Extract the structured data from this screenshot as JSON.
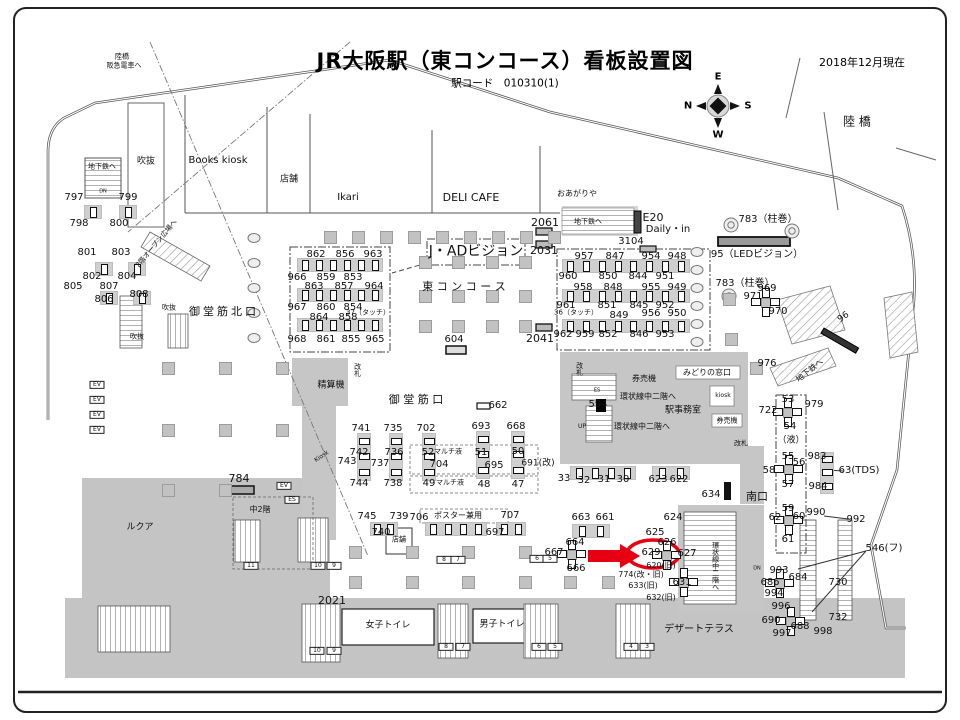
{
  "header": {
    "title": "JR大阪駅（東コンコース）看板設置図",
    "station_code": "駅コード　010310(1)",
    "date": "2018年12月現在"
  },
  "compass": {
    "top": "E",
    "left": "N",
    "right": "S",
    "bottom": "W"
  },
  "highlight": {
    "target_sign": "629",
    "marker": "red-arrow-and-red-circle",
    "color": "#e60012"
  },
  "map_labels": [
    {
      "t": "陸橋",
      "x": 122,
      "y": 57,
      "s": 7
    },
    {
      "t": "阪急電車へ",
      "x": 124,
      "y": 66,
      "s": 7
    },
    {
      "t": "地下鉄へ",
      "x": 102,
      "y": 167,
      "s": 7
    },
    {
      "t": "DN",
      "x": 103,
      "y": 192,
      "s": 5
    },
    {
      "t": "吹抜",
      "x": 146,
      "y": 162,
      "s": 9
    },
    {
      "t": "Books kiosk",
      "x": 218,
      "y": 161,
      "s": 10
    },
    {
      "t": "店舗",
      "x": 289,
      "y": 180,
      "s": 9
    },
    {
      "t": "Ikari",
      "x": 348,
      "y": 198,
      "s": 10
    },
    {
      "t": "DELI CAFE",
      "x": 471,
      "y": 198,
      "s": 11
    },
    {
      "t": "おあがりや",
      "x": 577,
      "y": 194,
      "s": 8
    },
    {
      "t": "地下鉄へ",
      "x": 588,
      "y": 222,
      "s": 7
    },
    {
      "t": "E20",
      "x": 653,
      "y": 218,
      "s": 11
    },
    {
      "t": "Daily・in",
      "x": 668,
      "y": 230,
      "s": 10
    },
    {
      "t": "陸 橋",
      "x": 857,
      "y": 122,
      "s": 12
    },
    {
      "t": "2階オープン広場へ",
      "x": 157,
      "y": 244,
      "s": 7,
      "r": -50
    },
    {
      "t": "御堂筋北口",
      "x": 224,
      "y": 312,
      "s": 11,
      "sp": 3
    },
    {
      "t": "J・ADビジョン",
      "x": 476,
      "y": 252,
      "s": 14
    },
    {
      "t": "東 コ ン コ ー ス",
      "x": 464,
      "y": 287,
      "s": 11
    },
    {
      "t": "吹抜",
      "x": 169,
      "y": 308,
      "s": 7
    },
    {
      "t": "吹抜",
      "x": 137,
      "y": 337,
      "s": 7
    },
    {
      "t": "783（柱巻）",
      "x": 768,
      "y": 220,
      "s": 10
    },
    {
      "t": "95（LEDビジョン）",
      "x": 757,
      "y": 255,
      "s": 10
    },
    {
      "t": "783（柱巻）",
      "x": 745,
      "y": 284,
      "s": 10
    },
    {
      "t": "96",
      "x": 844,
      "y": 318,
      "s": 9,
      "r": -35
    },
    {
      "t": "地下鉄へ",
      "x": 810,
      "y": 371,
      "s": 8,
      "r": -38
    },
    {
      "t": "精算機",
      "x": 331,
      "y": 386,
      "s": 9
    },
    {
      "t": "改札",
      "x": 357,
      "y": 370,
      "s": 7,
      "v": 1
    },
    {
      "t": "改札",
      "x": 579,
      "y": 369,
      "s": 7,
      "v": 1
    },
    {
      "t": "御 堂 筋 口",
      "x": 416,
      "y": 400,
      "s": 11
    },
    {
      "t": "マルチ液",
      "x": 448,
      "y": 452,
      "s": 7
    },
    {
      "t": "マルチ液",
      "x": 450,
      "y": 483,
      "s": 7
    },
    {
      "t": "券売機",
      "x": 644,
      "y": 379,
      "s": 8
    },
    {
      "t": "みどりの窓口",
      "x": 707,
      "y": 373,
      "s": 8
    },
    {
      "t": "環状線中二階へ",
      "x": 648,
      "y": 397,
      "s": 8
    },
    {
      "t": "駅事務室",
      "x": 683,
      "y": 411,
      "s": 9
    },
    {
      "t": "環状線中二階へ",
      "x": 642,
      "y": 427,
      "s": 8
    },
    {
      "t": "UP",
      "x": 582,
      "y": 427,
      "s": 6
    },
    {
      "t": "ES",
      "x": 597,
      "y": 391,
      "s": 5
    },
    {
      "t": "kiosk",
      "x": 723,
      "y": 396,
      "s": 6
    },
    {
      "t": "券売機",
      "x": 727,
      "y": 421,
      "s": 7
    },
    {
      "t": "改札",
      "x": 741,
      "y": 444,
      "s": 7
    },
    {
      "t": "南口",
      "x": 757,
      "y": 497,
      "s": 11
    },
    {
      "t": "（液）",
      "x": 791,
      "y": 441,
      "s": 9
    },
    {
      "t": "63(TDS)",
      "x": 859,
      "y": 471,
      "s": 10
    },
    {
      "t": "546(フ)",
      "x": 884,
      "y": 549,
      "s": 10
    },
    {
      "t": "ルクア",
      "x": 140,
      "y": 528,
      "s": 9
    },
    {
      "t": "中2階",
      "x": 260,
      "y": 510,
      "s": 8
    },
    {
      "t": "Kiosk",
      "x": 322,
      "y": 457,
      "s": 6,
      "r": -35
    },
    {
      "t": "店舗",
      "x": 399,
      "y": 540,
      "s": 7
    },
    {
      "t": "ポスター兼用",
      "x": 458,
      "y": 516,
      "s": 8
    },
    {
      "t": "女子トイレ",
      "x": 388,
      "y": 626,
      "s": 9
    },
    {
      "t": "男子トイレ",
      "x": 502,
      "y": 625,
      "s": 9
    },
    {
      "t": "デザートテラス",
      "x": 699,
      "y": 630,
      "s": 10
    },
    {
      "t": "環状線中二階へ",
      "x": 715,
      "y": 566,
      "s": 7,
      "v": 1
    },
    {
      "t": "DN",
      "x": 757,
      "y": 569,
      "s": 5
    },
    {
      "t": "797",
      "x": 74,
      "y": 198,
      "s": 10
    },
    {
      "t": "799",
      "x": 128,
      "y": 198,
      "s": 10
    },
    {
      "t": "798",
      "x": 79,
      "y": 224,
      "s": 10
    },
    {
      "t": "800",
      "x": 119,
      "y": 224,
      "s": 10
    },
    {
      "t": "801",
      "x": 87,
      "y": 253,
      "s": 10
    },
    {
      "t": "803",
      "x": 121,
      "y": 253,
      "s": 10
    },
    {
      "t": "802",
      "x": 92,
      "y": 277,
      "s": 10
    },
    {
      "t": "804",
      "x": 127,
      "y": 277,
      "s": 10
    },
    {
      "t": "805",
      "x": 73,
      "y": 287,
      "s": 10
    },
    {
      "t": "807",
      "x": 109,
      "y": 287,
      "s": 10
    },
    {
      "t": "806",
      "x": 104,
      "y": 300,
      "s": 10
    },
    {
      "t": "808",
      "x": 139,
      "y": 295,
      "s": 10
    },
    {
      "t": "862",
      "x": 316,
      "y": 255,
      "s": 10
    },
    {
      "t": "856",
      "x": 345,
      "y": 255,
      "s": 10
    },
    {
      "t": "963",
      "x": 373,
      "y": 255,
      "s": 10
    },
    {
      "t": "966",
      "x": 297,
      "y": 278,
      "s": 10
    },
    {
      "t": "859",
      "x": 326,
      "y": 278,
      "s": 10
    },
    {
      "t": "853",
      "x": 353,
      "y": 278,
      "s": 10
    },
    {
      "t": "863",
      "x": 314,
      "y": 287,
      "s": 10
    },
    {
      "t": "857",
      "x": 344,
      "y": 287,
      "s": 10
    },
    {
      "t": "964",
      "x": 374,
      "y": 287,
      "s": 10
    },
    {
      "t": "967",
      "x": 297,
      "y": 308,
      "s": 10
    },
    {
      "t": "860",
      "x": 326,
      "y": 308,
      "s": 10
    },
    {
      "t": "854",
      "x": 353,
      "y": 308,
      "s": 10
    },
    {
      "t": "37（タッチ）",
      "x": 368,
      "y": 313,
      "s": 7
    },
    {
      "t": "864",
      "x": 319,
      "y": 318,
      "s": 10
    },
    {
      "t": "858",
      "x": 348,
      "y": 318,
      "s": 10
    },
    {
      "t": "968",
      "x": 297,
      "y": 340,
      "s": 10
    },
    {
      "t": "861",
      "x": 326,
      "y": 340,
      "s": 10
    },
    {
      "t": "855",
      "x": 351,
      "y": 340,
      "s": 10
    },
    {
      "t": "965",
      "x": 375,
      "y": 340,
      "s": 10
    },
    {
      "t": "957",
      "x": 584,
      "y": 257,
      "s": 10
    },
    {
      "t": "847",
      "x": 615,
      "y": 257,
      "s": 10
    },
    {
      "t": "954",
      "x": 651,
      "y": 257,
      "s": 10
    },
    {
      "t": "948",
      "x": 677,
      "y": 257,
      "s": 10
    },
    {
      "t": "960",
      "x": 568,
      "y": 277,
      "s": 10
    },
    {
      "t": "850",
      "x": 608,
      "y": 277,
      "s": 10
    },
    {
      "t": "844",
      "x": 638,
      "y": 277,
      "s": 10
    },
    {
      "t": "951",
      "x": 665,
      "y": 277,
      "s": 10
    },
    {
      "t": "958",
      "x": 583,
      "y": 288,
      "s": 10
    },
    {
      "t": "848",
      "x": 613,
      "y": 288,
      "s": 10
    },
    {
      "t": "955",
      "x": 651,
      "y": 288,
      "s": 10
    },
    {
      "t": "949",
      "x": 677,
      "y": 288,
      "s": 10
    },
    {
      "t": "961",
      "x": 566,
      "y": 306,
      "s": 10
    },
    {
      "t": "851",
      "x": 607,
      "y": 306,
      "s": 10
    },
    {
      "t": "845",
      "x": 639,
      "y": 306,
      "s": 10
    },
    {
      "t": "952",
      "x": 665,
      "y": 306,
      "s": 10
    },
    {
      "t": "36（タッチ）",
      "x": 576,
      "y": 313,
      "s": 7
    },
    {
      "t": "849",
      "x": 619,
      "y": 316,
      "s": 10
    },
    {
      "t": "956",
      "x": 651,
      "y": 314,
      "s": 10
    },
    {
      "t": "950",
      "x": 677,
      "y": 314,
      "s": 10
    },
    {
      "t": "962",
      "x": 563,
      "y": 335,
      "s": 10
    },
    {
      "t": "959",
      "x": 585,
      "y": 335,
      "s": 10
    },
    {
      "t": "852",
      "x": 608,
      "y": 335,
      "s": 10
    },
    {
      "t": "846",
      "x": 639,
      "y": 335,
      "s": 10
    },
    {
      "t": "953",
      "x": 665,
      "y": 335,
      "s": 10
    },
    {
      "t": "2061",
      "x": 545,
      "y": 223,
      "s": 11
    },
    {
      "t": "2031",
      "x": 544,
      "y": 251,
      "s": 11
    },
    {
      "t": "2041",
      "x": 540,
      "y": 339,
      "s": 11
    },
    {
      "t": "3104",
      "x": 631,
      "y": 242,
      "s": 10
    },
    {
      "t": "604",
      "x": 454,
      "y": 340,
      "s": 10
    },
    {
      "t": "662",
      "x": 498,
      "y": 406,
      "s": 10
    },
    {
      "t": "594",
      "x": 598,
      "y": 405,
      "s": 10
    },
    {
      "t": "741",
      "x": 361,
      "y": 429,
      "s": 10
    },
    {
      "t": "735",
      "x": 393,
      "y": 429,
      "s": 10
    },
    {
      "t": "702",
      "x": 426,
      "y": 429,
      "s": 10
    },
    {
      "t": "693",
      "x": 481,
      "y": 427,
      "s": 10
    },
    {
      "t": "668",
      "x": 516,
      "y": 427,
      "s": 10
    },
    {
      "t": "742",
      "x": 359,
      "y": 453,
      "s": 10
    },
    {
      "t": "736",
      "x": 394,
      "y": 453,
      "s": 10
    },
    {
      "t": "52",
      "x": 428,
      "y": 453,
      "s": 10
    },
    {
      "t": "51",
      "x": 481,
      "y": 453,
      "s": 10
    },
    {
      "t": "50",
      "x": 518,
      "y": 452,
      "s": 10
    },
    {
      "t": "743",
      "x": 347,
      "y": 462,
      "s": 10
    },
    {
      "t": "737",
      "x": 380,
      "y": 464,
      "s": 10
    },
    {
      "t": "704",
      "x": 439,
      "y": 465,
      "s": 10
    },
    {
      "t": "695",
      "x": 494,
      "y": 466,
      "s": 10
    },
    {
      "t": "691(改)",
      "x": 538,
      "y": 464,
      "s": 9
    },
    {
      "t": "744",
      "x": 359,
      "y": 484,
      "s": 10
    },
    {
      "t": "738",
      "x": 393,
      "y": 484,
      "s": 10
    },
    {
      "t": "49",
      "x": 429,
      "y": 484,
      "s": 10
    },
    {
      "t": "48",
      "x": 484,
      "y": 485,
      "s": 10
    },
    {
      "t": "47",
      "x": 518,
      "y": 485,
      "s": 10
    },
    {
      "t": "33",
      "x": 564,
      "y": 479,
      "s": 10
    },
    {
      "t": "32",
      "x": 584,
      "y": 481,
      "s": 10
    },
    {
      "t": "31",
      "x": 604,
      "y": 480,
      "s": 10
    },
    {
      "t": "30",
      "x": 623,
      "y": 480,
      "s": 10
    },
    {
      "t": "623",
      "x": 658,
      "y": 480,
      "s": 10
    },
    {
      "t": "622",
      "x": 679,
      "y": 480,
      "s": 10
    },
    {
      "t": "634",
      "x": 711,
      "y": 495,
      "s": 10
    },
    {
      "t": "745",
      "x": 367,
      "y": 517,
      "s": 10
    },
    {
      "t": "739",
      "x": 399,
      "y": 517,
      "s": 10
    },
    {
      "t": "706",
      "x": 419,
      "y": 518,
      "s": 10
    },
    {
      "t": "707",
      "x": 510,
      "y": 516,
      "s": 10
    },
    {
      "t": "740",
      "x": 381,
      "y": 533,
      "s": 10
    },
    {
      "t": "697",
      "x": 495,
      "y": 533,
      "s": 10
    },
    {
      "t": "663",
      "x": 581,
      "y": 518,
      "s": 10
    },
    {
      "t": "661",
      "x": 605,
      "y": 518,
      "s": 10
    },
    {
      "t": "664",
      "x": 575,
      "y": 543,
      "s": 10
    },
    {
      "t": "667",
      "x": 554,
      "y": 553,
      "s": 10
    },
    {
      "t": "666",
      "x": 576,
      "y": 569,
      "s": 10
    },
    {
      "t": "624",
      "x": 673,
      "y": 518,
      "s": 10
    },
    {
      "t": "625",
      "x": 655,
      "y": 533,
      "s": 10
    },
    {
      "t": "626",
      "x": 667,
      "y": 543,
      "s": 10
    },
    {
      "t": "629",
      "x": 651,
      "y": 553,
      "s": 10
    },
    {
      "t": "627",
      "x": 687,
      "y": 554,
      "s": 10
    },
    {
      "t": "620(旧)",
      "x": 661,
      "y": 566,
      "s": 8
    },
    {
      "t": "774(改・旧)",
      "x": 641,
      "y": 575,
      "s": 8
    },
    {
      "t": "633(旧)",
      "x": 643,
      "y": 586,
      "s": 8
    },
    {
      "t": "631",
      "x": 682,
      "y": 583,
      "s": 10
    },
    {
      "t": "632(旧)",
      "x": 661,
      "y": 598,
      "s": 8
    },
    {
      "t": "2021",
      "x": 332,
      "y": 601,
      "s": 11
    },
    {
      "t": "722",
      "x": 768,
      "y": 411,
      "s": 10
    },
    {
      "t": "53",
      "x": 788,
      "y": 400,
      "s": 10
    },
    {
      "t": "54",
      "x": 790,
      "y": 427,
      "s": 10
    },
    {
      "t": "979",
      "x": 814,
      "y": 405,
      "s": 10
    },
    {
      "t": "55",
      "x": 788,
      "y": 457,
      "s": 10
    },
    {
      "t": "56",
      "x": 799,
      "y": 463,
      "s": 10
    },
    {
      "t": "58",
      "x": 769,
      "y": 471,
      "s": 10
    },
    {
      "t": "57",
      "x": 788,
      "y": 485,
      "s": 10
    },
    {
      "t": "983",
      "x": 817,
      "y": 457,
      "s": 10
    },
    {
      "t": "984",
      "x": 818,
      "y": 487,
      "s": 10
    },
    {
      "t": "59",
      "x": 788,
      "y": 509,
      "s": 10
    },
    {
      "t": "60",
      "x": 799,
      "y": 517,
      "s": 10
    },
    {
      "t": "62",
      "x": 775,
      "y": 518,
      "s": 10
    },
    {
      "t": "61",
      "x": 788,
      "y": 540,
      "s": 10
    },
    {
      "t": "990",
      "x": 816,
      "y": 513,
      "s": 10
    },
    {
      "t": "992",
      "x": 856,
      "y": 520,
      "s": 10
    },
    {
      "t": "993",
      "x": 779,
      "y": 571,
      "s": 10
    },
    {
      "t": "684",
      "x": 798,
      "y": 578,
      "s": 10
    },
    {
      "t": "686",
      "x": 770,
      "y": 583,
      "s": 10
    },
    {
      "t": "730",
      "x": 838,
      "y": 583,
      "s": 10
    },
    {
      "t": "994",
      "x": 774,
      "y": 594,
      "s": 10
    },
    {
      "t": "996",
      "x": 781,
      "y": 607,
      "s": 10
    },
    {
      "t": "690",
      "x": 771,
      "y": 621,
      "s": 10
    },
    {
      "t": "688",
      "x": 800,
      "y": 627,
      "s": 10
    },
    {
      "t": "997",
      "x": 782,
      "y": 634,
      "s": 10
    },
    {
      "t": "998",
      "x": 823,
      "y": 632,
      "s": 10
    },
    {
      "t": "732",
      "x": 838,
      "y": 618,
      "s": 10
    },
    {
      "t": "969",
      "x": 767,
      "y": 289,
      "s": 10
    },
    {
      "t": "971",
      "x": 753,
      "y": 297,
      "s": 10
    },
    {
      "t": "970",
      "x": 778,
      "y": 312,
      "s": 10
    },
    {
      "t": "976",
      "x": 767,
      "y": 364,
      "s": 10
    },
    {
      "t": "EV",
      "x": 97,
      "y": 385,
      "s": 6,
      "box": 1
    },
    {
      "t": "EV",
      "x": 97,
      "y": 400,
      "s": 6,
      "box": 1
    },
    {
      "t": "EV",
      "x": 97,
      "y": 415,
      "s": 6,
      "box": 1
    },
    {
      "t": "EV",
      "x": 97,
      "y": 430,
      "s": 6,
      "box": 1
    },
    {
      "t": "EV",
      "x": 284,
      "y": 486,
      "s": 6,
      "box": 1
    },
    {
      "t": "ES",
      "x": 292,
      "y": 500,
      "s": 6,
      "box": 1
    },
    {
      "t": "11",
      "x": 251,
      "y": 566,
      "s": 6,
      "box": 1
    },
    {
      "t": "10",
      "x": 318,
      "y": 566,
      "s": 6,
      "box": 1
    },
    {
      "t": "9",
      "x": 334,
      "y": 566,
      "s": 6,
      "box": 1
    },
    {
      "t": "8",
      "x": 444,
      "y": 560,
      "s": 6,
      "box": 1
    },
    {
      "t": "7",
      "x": 458,
      "y": 560,
      "s": 6,
      "box": 1
    },
    {
      "t": "6",
      "x": 537,
      "y": 559,
      "s": 6,
      "box": 1
    },
    {
      "t": "5",
      "x": 550,
      "y": 559,
      "s": 6,
      "box": 1
    },
    {
      "t": "10",
      "x": 317,
      "y": 651,
      "s": 6,
      "box": 1
    },
    {
      "t": "9",
      "x": 334,
      "y": 651,
      "s": 6,
      "box": 1
    },
    {
      "t": "8",
      "x": 446,
      "y": 647,
      "s": 6,
      "box": 1
    },
    {
      "t": "7",
      "x": 463,
      "y": 647,
      "s": 6,
      "box": 1
    },
    {
      "t": "6",
      "x": 539,
      "y": 647,
      "s": 6,
      "box": 1
    },
    {
      "t": "5",
      "x": 555,
      "y": 647,
      "s": 6,
      "box": 1
    },
    {
      "t": "4",
      "x": 631,
      "y": 647,
      "s": 6,
      "box": 1
    },
    {
      "t": "3",
      "x": 647,
      "y": 647,
      "s": 6,
      "box": 1
    }
  ]
}
